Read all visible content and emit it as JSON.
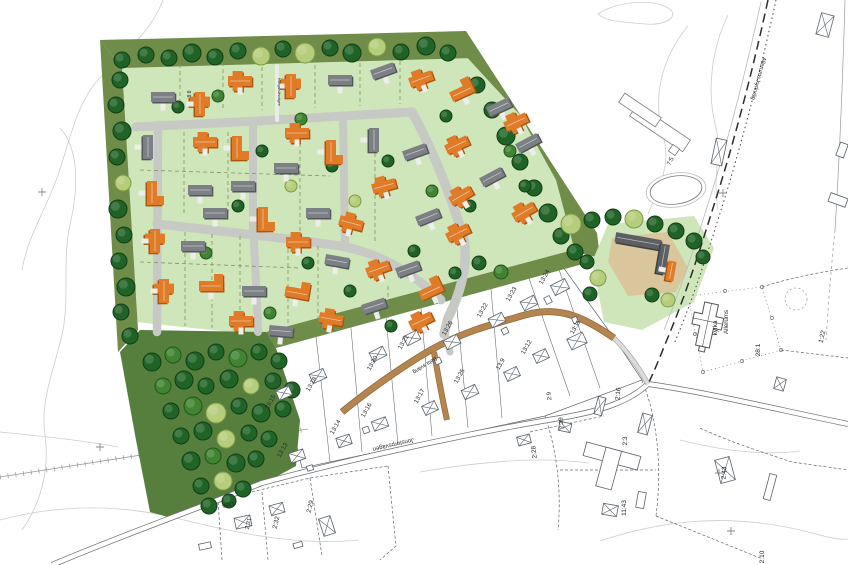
{
  "palette": {
    "background": "#ffffff",
    "dev_green": "#cfe6bb",
    "band_green": "#6f8c49",
    "forest_green": "#567f3d",
    "farm_sand": "#d9c69c",
    "road_gray": "#c7c9c5",
    "road_brown": "#b5854f",
    "road_brown_edge": "#8f6a3c",
    "house_orange": "#e07b28",
    "house_orange_dark": "#a85612",
    "house_gray": "#7c8084",
    "house_gray_dark": "#53575b",
    "house_farm": "#5d6063",
    "house_farm_dark": "#3e4144",
    "tree_dark_fill": "#1f6426",
    "tree_dark_edge": "#123d15",
    "tree_light_fill": "#b6cd7c",
    "tree_light_edge": "#7d9c44",
    "tree_mid_fill": "#3f8432",
    "tree_mid_edge": "#245418",
    "cadastral_line": "#5a626b",
    "contour": "#cdcdcd",
    "label_color": "#26282a"
  },
  "labels": [
    {
      "t": "8:8",
      "x": 191,
      "y": 94,
      "r": -90,
      "s": 5
    },
    {
      "t": "Kungshultsvägen",
      "x": 278,
      "y": 92,
      "r": 90,
      "s": 3.6
    },
    {
      "t": "7:5",
      "x": 672,
      "y": 162,
      "r": -65,
      "s": 6
    },
    {
      "t": "Allerums",
      "x": 728,
      "y": 322,
      "r": -90,
      "s": 6.2
    },
    {
      "t": "kyrka",
      "x": 717,
      "y": 328,
      "r": -90,
      "s": 6.2
    },
    {
      "t": "28:1",
      "x": 760,
      "y": 350,
      "r": -90,
      "s": 6.5
    },
    {
      "t": "1:22",
      "x": 824,
      "y": 337,
      "r": -78,
      "s": 6.5
    },
    {
      "t": "2:16",
      "x": 620,
      "y": 394,
      "r": -85,
      "s": 6.5
    },
    {
      "t": "2:9",
      "x": 551,
      "y": 396,
      "r": -95,
      "s": 6
    },
    {
      "t": "2:39",
      "x": 563,
      "y": 423,
      "r": -95,
      "s": 6
    },
    {
      "t": "2:3",
      "x": 627,
      "y": 441,
      "r": -90,
      "s": 6.5
    },
    {
      "t": "2:28",
      "x": 536,
      "y": 452,
      "r": -97,
      "s": 6.5
    },
    {
      "t": "11:43",
      "x": 626,
      "y": 508,
      "r": -90,
      "s": 6.5
    },
    {
      "t": "2:43",
      "x": 726,
      "y": 473,
      "r": -87,
      "s": 6.5
    },
    {
      "t": "2:10",
      "x": 764,
      "y": 557,
      "r": -90,
      "s": 6.5
    },
    {
      "t": "2:31",
      "x": 250,
      "y": 524,
      "r": -76,
      "s": 6
    },
    {
      "t": "2:32",
      "x": 278,
      "y": 523,
      "r": -76,
      "s": 6.5
    },
    {
      "t": "2:29",
      "x": 312,
      "y": 507,
      "r": -76,
      "s": 6.5
    },
    {
      "t": "13:24",
      "x": 546,
      "y": 278,
      "r": -60,
      "s": 6.2
    },
    {
      "t": "13:23",
      "x": 513,
      "y": 295,
      "r": -60,
      "s": 6.2
    },
    {
      "t": "13:22",
      "x": 484,
      "y": 311,
      "r": -60,
      "s": 6.2
    },
    {
      "t": "13:26",
      "x": 449,
      "y": 329,
      "r": -60,
      "s": 6.2
    },
    {
      "t": "13:21",
      "x": 405,
      "y": 343,
      "r": -60,
      "s": 6.2
    },
    {
      "t": "13:20",
      "x": 374,
      "y": 364,
      "r": -60,
      "s": 6.2
    },
    {
      "t": "13:18",
      "x": 313,
      "y": 385,
      "r": -60,
      "s": 6.2
    },
    {
      "t": "13:15",
      "x": 272,
      "y": 403,
      "r": -60,
      "s": 6.2
    },
    {
      "t": "13:16",
      "x": 368,
      "y": 411,
      "r": -60,
      "s": 6.2
    },
    {
      "t": "13:14",
      "x": 337,
      "y": 428,
      "r": -60,
      "s": 6.2
    },
    {
      "t": "13:13",
      "x": 284,
      "y": 451,
      "r": -60,
      "s": 6.2
    },
    {
      "t": "13:17",
      "x": 421,
      "y": 397,
      "r": -60,
      "s": 6.2
    },
    {
      "t": "13:25",
      "x": 461,
      "y": 377,
      "r": -60,
      "s": 6.2
    },
    {
      "t": "13:9",
      "x": 502,
      "y": 365,
      "r": -60,
      "s": 6.2
    },
    {
      "t": "13:12",
      "x": 528,
      "y": 348,
      "r": -60,
      "s": 6.2
    },
    {
      "t": "13:11",
      "x": 577,
      "y": 328,
      "r": -60,
      "s": 6.2
    },
    {
      "t": "Allerums kyrkväg",
      "x": 757,
      "y": 78,
      "r": 105,
      "s": 5.8
    },
    {
      "t": "Jonstorpsvägen",
      "x": 393,
      "y": 443,
      "r": 167,
      "s": 6
    },
    {
      "t": "Bela sväng",
      "x": 424,
      "y": 364,
      "r": 148,
      "s": 5.5
    },
    {
      "t": "1386",
      "x": 228,
      "y": 503,
      "r": 166,
      "s": 5.5
    }
  ],
  "houses": [
    [
      163,
      97,
      0,
      "g",
      "R"
    ],
    [
      200,
      104,
      90,
      "o",
      "T"
    ],
    [
      240,
      81,
      0,
      "o",
      "T"
    ],
    [
      291,
      86,
      90,
      "o",
      "T"
    ],
    [
      340,
      80,
      0,
      "g",
      "R"
    ],
    [
      383,
      71,
      -20,
      "g",
      "R"
    ],
    [
      421,
      79,
      -20,
      "o",
      "T"
    ],
    [
      462,
      92,
      -25,
      "o",
      "L"
    ],
    [
      499,
      107,
      -25,
      "g",
      "R"
    ],
    [
      516,
      122,
      -25,
      "o",
      "T"
    ],
    [
      528,
      143,
      -28,
      "g",
      "R"
    ],
    [
      457,
      145,
      -25,
      "o",
      "T"
    ],
    [
      492,
      177,
      -28,
      "g",
      "R"
    ],
    [
      461,
      196,
      -30,
      "o",
      "T"
    ],
    [
      524,
      212,
      -30,
      "o",
      "T"
    ],
    [
      148,
      147,
      90,
      "g",
      "R"
    ],
    [
      205,
      142,
      0,
      "o",
      "T"
    ],
    [
      237,
      148,
      90,
      "o",
      "L"
    ],
    [
      297,
      133,
      0,
      "o",
      "T"
    ],
    [
      331,
      152,
      90,
      "o",
      "L"
    ],
    [
      374,
      140,
      90,
      "g",
      "R"
    ],
    [
      415,
      152,
      -20,
      "g",
      "R"
    ],
    [
      286,
      168,
      0,
      "g",
      "R"
    ],
    [
      384,
      186,
      -15,
      "o",
      "T"
    ],
    [
      152,
      193,
      90,
      "o",
      "L"
    ],
    [
      200,
      190,
      0,
      "g",
      "R"
    ],
    [
      243,
      186,
      0,
      "g",
      "R"
    ],
    [
      215,
      213,
      0,
      "g",
      "R"
    ],
    [
      263,
      219,
      90,
      "o",
      "L"
    ],
    [
      318,
      213,
      0,
      "g",
      "R"
    ],
    [
      351,
      223,
      15,
      "o",
      "T"
    ],
    [
      428,
      217,
      -22,
      "g",
      "R"
    ],
    [
      458,
      233,
      -26,
      "o",
      "T"
    ],
    [
      298,
      242,
      0,
      "o",
      "T"
    ],
    [
      337,
      261,
      10,
      "g",
      "R"
    ],
    [
      155,
      241,
      90,
      "o",
      "T"
    ],
    [
      193,
      246,
      0,
      "g",
      "R"
    ],
    [
      164,
      291,
      90,
      "o",
      "T"
    ],
    [
      211,
      286,
      0,
      "o",
      "L"
    ],
    [
      254,
      291,
      0,
      "g",
      "R"
    ],
    [
      297,
      293,
      10,
      "o",
      "L"
    ],
    [
      378,
      269,
      -20,
      "o",
      "T"
    ],
    [
      408,
      269,
      -20,
      "g",
      "R"
    ],
    [
      431,
      291,
      -25,
      "o",
      "L"
    ],
    [
      374,
      306,
      -18,
      "g",
      "R"
    ],
    [
      241,
      321,
      0,
      "o",
      "T"
    ],
    [
      281,
      331,
      5,
      "g",
      "R"
    ],
    [
      331,
      319,
      10,
      "o",
      "T"
    ],
    [
      421,
      321,
      -25,
      "o",
      "T"
    ],
    [
      638,
      241,
      10,
      "f",
      "R",
      46,
      10
    ],
    [
      663,
      259,
      100,
      "f",
      "R",
      30,
      9
    ],
    [
      671,
      271,
      100,
      "o",
      "R",
      20,
      8
    ]
  ],
  "existing_buildings": [
    [
      560,
      287,
      -27,
      16,
      11
    ],
    [
      529,
      303,
      -27,
      15,
      10
    ],
    [
      497,
      320,
      -27,
      15,
      10
    ],
    [
      452,
      342,
      -27,
      15,
      10
    ],
    [
      412,
      338,
      -27,
      15,
      10
    ],
    [
      378,
      354,
      -27,
      15,
      10
    ],
    [
      318,
      376,
      -24,
      15,
      10
    ],
    [
      284,
      393,
      -24,
      14,
      10
    ],
    [
      470,
      392,
      -25,
      15,
      10
    ],
    [
      430,
      408,
      -25,
      14,
      10
    ],
    [
      380,
      424,
      -20,
      15,
      10
    ],
    [
      344,
      441,
      -18,
      14,
      10
    ],
    [
      297,
      456,
      -18,
      15,
      10
    ],
    [
      512,
      374,
      -25,
      14,
      10
    ],
    [
      541,
      356,
      -25,
      14,
      10
    ],
    [
      577,
      341,
      -25,
      17,
      12
    ],
    [
      243,
      522,
      -12,
      16,
      11
    ],
    [
      277,
      509,
      -15,
      14,
      10
    ],
    [
      327,
      526,
      72,
      18,
      12
    ],
    [
      524,
      440,
      -15,
      13,
      9
    ],
    [
      565,
      427,
      12,
      12,
      9
    ],
    [
      600,
      406,
      15,
      8,
      18
    ],
    [
      610,
      510,
      10,
      15,
      11
    ],
    [
      641,
      500,
      10,
      8,
      16,
      1
    ],
    [
      725,
      470,
      -15,
      15,
      24
    ],
    [
      770,
      487,
      15,
      7,
      26,
      1
    ],
    [
      780,
      384,
      15,
      10,
      12
    ],
    [
      719,
      152,
      12,
      11,
      26
    ],
    [
      825,
      25,
      15,
      13,
      22
    ],
    [
      842,
      150,
      20,
      8,
      14,
      1
    ],
    [
      838,
      200,
      -70,
      9,
      18,
      1
    ],
    [
      645,
      424,
      15,
      10,
      20
    ],
    [
      205,
      546,
      -12,
      12,
      6,
      1
    ],
    [
      298,
      545,
      -15,
      9,
      5,
      1
    ],
    [
      366,
      430,
      -20,
      6,
      6,
      1
    ],
    [
      310,
      468,
      -18,
      6,
      5,
      1
    ],
    [
      548,
      300,
      -27,
      6,
      7,
      1
    ],
    [
      505,
      331,
      -27,
      6,
      6,
      1
    ],
    [
      438,
      361,
      -25,
      6,
      6,
      1
    ],
    [
      575,
      320,
      -25,
      5,
      6,
      1
    ],
    [
      604,
      482,
      15,
      9,
      6,
      1
    ]
  ],
  "trees": [
    [
      122,
      60,
      8,
      1
    ],
    [
      146,
      55,
      8,
      1
    ],
    [
      169,
      58,
      8,
      1
    ],
    [
      192,
      53,
      9,
      1
    ],
    [
      215,
      57,
      8,
      1
    ],
    [
      238,
      51,
      8,
      1
    ],
    [
      261,
      56,
      9,
      2
    ],
    [
      283,
      49,
      8,
      1
    ],
    [
      305,
      53,
      10,
      2
    ],
    [
      330,
      48,
      8,
      1
    ],
    [
      352,
      53,
      9,
      1
    ],
    [
      377,
      47,
      9,
      2
    ],
    [
      401,
      52,
      8,
      1
    ],
    [
      426,
      46,
      9,
      1
    ],
    [
      448,
      53,
      8,
      1
    ],
    [
      120,
      80,
      8,
      1
    ],
    [
      116,
      105,
      8,
      1
    ],
    [
      122,
      131,
      9,
      1
    ],
    [
      117,
      157,
      8,
      1
    ],
    [
      123,
      183,
      8,
      2
    ],
    [
      118,
      209,
      9,
      1
    ],
    [
      124,
      235,
      8,
      1
    ],
    [
      119,
      261,
      8,
      1
    ],
    [
      126,
      287,
      9,
      1
    ],
    [
      121,
      312,
      8,
      1
    ],
    [
      130,
      336,
      8,
      1
    ],
    [
      477,
      85,
      8,
      1
    ],
    [
      492,
      110,
      8,
      1
    ],
    [
      506,
      136,
      9,
      1
    ],
    [
      520,
      162,
      8,
      1
    ],
    [
      534,
      188,
      8,
      1
    ],
    [
      548,
      213,
      9,
      1
    ],
    [
      561,
      236,
      8,
      1
    ],
    [
      575,
      252,
      8,
      1
    ],
    [
      571,
      224,
      10,
      2
    ],
    [
      592,
      220,
      8,
      1
    ],
    [
      613,
      217,
      8,
      1
    ],
    [
      634,
      219,
      9,
      2
    ],
    [
      655,
      224,
      8,
      1
    ],
    [
      676,
      231,
      8,
      1
    ],
    [
      694,
      241,
      8,
      1
    ],
    [
      703,
      257,
      7,
      1
    ],
    [
      587,
      262,
      7,
      1
    ],
    [
      598,
      278,
      8,
      2
    ],
    [
      590,
      294,
      7,
      1
    ],
    [
      652,
      295,
      7,
      1
    ],
    [
      668,
      300,
      7,
      2
    ],
    [
      152,
      362,
      9,
      1
    ],
    [
      173,
      355,
      8,
      3
    ],
    [
      195,
      361,
      9,
      1
    ],
    [
      216,
      352,
      8,
      1
    ],
    [
      238,
      358,
      9,
      3
    ],
    [
      259,
      352,
      8,
      1
    ],
    [
      279,
      361,
      8,
      1
    ],
    [
      163,
      386,
      8,
      3
    ],
    [
      184,
      380,
      9,
      1
    ],
    [
      206,
      386,
      8,
      1
    ],
    [
      229,
      379,
      9,
      1
    ],
    [
      251,
      386,
      8,
      2
    ],
    [
      273,
      381,
      8,
      1
    ],
    [
      292,
      390,
      8,
      1
    ],
    [
      171,
      411,
      8,
      1
    ],
    [
      193,
      406,
      9,
      3
    ],
    [
      216,
      413,
      10,
      2
    ],
    [
      239,
      406,
      8,
      1
    ],
    [
      261,
      413,
      9,
      1
    ],
    [
      283,
      409,
      8,
      1
    ],
    [
      181,
      436,
      8,
      1
    ],
    [
      203,
      431,
      9,
      1
    ],
    [
      226,
      439,
      9,
      2
    ],
    [
      249,
      433,
      8,
      1
    ],
    [
      269,
      439,
      8,
      1
    ],
    [
      191,
      461,
      9,
      1
    ],
    [
      213,
      456,
      8,
      3
    ],
    [
      236,
      463,
      9,
      1
    ],
    [
      256,
      459,
      8,
      1
    ],
    [
      201,
      486,
      8,
      1
    ],
    [
      223,
      481,
      9,
      2
    ],
    [
      243,
      489,
      8,
      1
    ],
    [
      209,
      506,
      8,
      1
    ],
    [
      229,
      501,
      7,
      1
    ],
    [
      479,
      263,
      7,
      1
    ],
    [
      501,
      272,
      7,
      3
    ],
    [
      455,
      273,
      6,
      1
    ],
    [
      178,
      107,
      6,
      1
    ],
    [
      218,
      96,
      6,
      3
    ],
    [
      262,
      151,
      6,
      1
    ],
    [
      291,
      186,
      6,
      2
    ],
    [
      238,
      206,
      6,
      1
    ],
    [
      206,
      253,
      6,
      3
    ],
    [
      308,
      263,
      6,
      1
    ],
    [
      355,
      201,
      6,
      2
    ],
    [
      332,
      166,
      6,
      1
    ],
    [
      301,
      119,
      6,
      3
    ],
    [
      388,
      161,
      6,
      1
    ],
    [
      432,
      191,
      6,
      3
    ],
    [
      414,
      251,
      6,
      1
    ],
    [
      470,
      206,
      6,
      1
    ],
    [
      510,
      151,
      6,
      3
    ],
    [
      446,
      116,
      6,
      1
    ],
    [
      350,
      291,
      6,
      1
    ],
    [
      391,
      326,
      6,
      1
    ],
    [
      270,
      313,
      6,
      3
    ],
    [
      525,
      186,
      6,
      1
    ]
  ],
  "plot_lines": [
    [
      180,
      64,
      180,
      112
    ],
    [
      223,
      62,
      223,
      110
    ],
    [
      262,
      60,
      262,
      110
    ],
    [
      315,
      58,
      315,
      108
    ],
    [
      360,
      56,
      360,
      106
    ],
    [
      400,
      54,
      400,
      104
    ],
    [
      184,
      132,
      184,
      216
    ],
    [
      228,
      132,
      228,
      216
    ],
    [
      300,
      136,
      300,
      232
    ],
    [
      375,
      132,
      375,
      244
    ],
    [
      140,
      170,
      330,
      176
    ],
    [
      140,
      262,
      300,
      268
    ],
    [
      185,
      232,
      185,
      326
    ],
    [
      212,
      234,
      212,
      328
    ],
    [
      240,
      236,
      240,
      330
    ],
    [
      288,
      242,
      288,
      330
    ],
    [
      318,
      246,
      318,
      328
    ],
    [
      388,
      286,
      388,
      318
    ]
  ],
  "survey_crosses": [
    [
      42,
      192
    ],
    [
      723,
      193
    ],
    [
      719,
      473
    ],
    [
      731,
      531
    ],
    [
      100,
      447
    ]
  ]
}
